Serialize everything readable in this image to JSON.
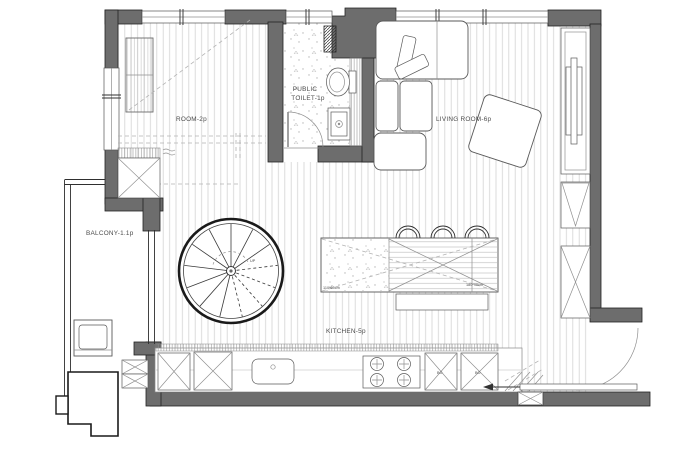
{
  "meta": {
    "drawing_type": "apartment floor plan, top view"
  },
  "colors": {
    "wall": "#6d6d6d",
    "wall-stroke": "#222222",
    "line": "#2f2f2f",
    "light-line": "#8f8f8f",
    "furn-line": "#5a5a5a",
    "dash-line": "#b3b3b3",
    "label": "#4c4c4c",
    "floor-line": "#d7d7d7"
  },
  "labels": {
    "room": "ROOM-2p",
    "toilet_line1": "PUBLIC",
    "toilet_line2": "TOILET-1p",
    "living": "LIVING ROOM-6p",
    "balcony": "BALCONY-1.1p",
    "kitchen": "KITCHEN-5p",
    "stairs_up": "UP",
    "island_dim_left": "110*60cm",
    "island_dim_right": "180*90cm",
    "oven_left": "BO",
    "oven_right": "BO"
  }
}
